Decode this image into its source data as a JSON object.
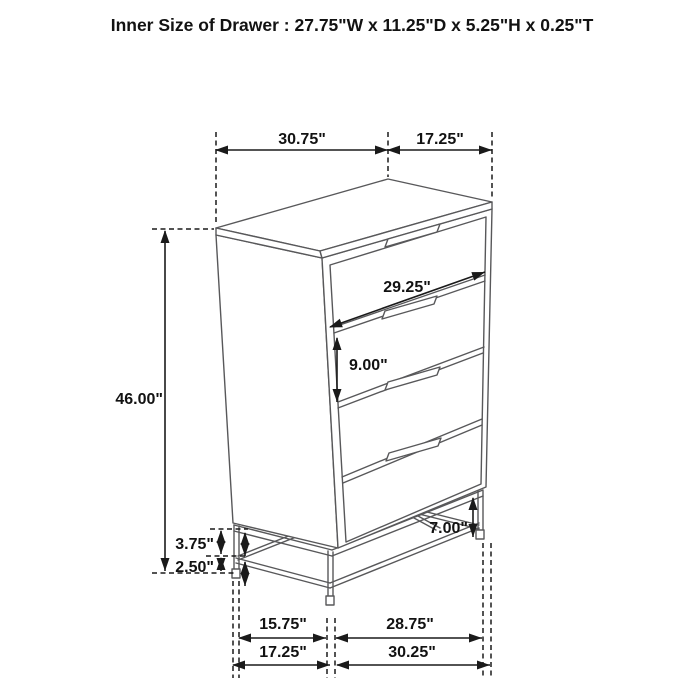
{
  "title": "Inner Size of Drawer : 27.75\"W x 11.25\"D x 5.25\"H x 0.25\"T",
  "product": "four-drawer-chest-dimension-diagram",
  "dimensions": {
    "top_left": "30.75\"",
    "top_right": "17.25\"",
    "overall_height": "46.00\"",
    "drawer_front_width": "29.25\"",
    "drawer_spacing": "9.00\"",
    "base_clearance": "7.00\"",
    "base_upper_gap": "3.75\"",
    "base_lower_gap": "2.50\"",
    "base_inner_left": "15.75\"",
    "base_inner_right": "28.75\"",
    "base_outer_left": "17.25\"",
    "base_outer_right": "30.25\""
  },
  "colors": {
    "background": "#ffffff",
    "furniture_line": "#58585a",
    "dimension_line": "#1a1a1a",
    "text": "#121212"
  }
}
